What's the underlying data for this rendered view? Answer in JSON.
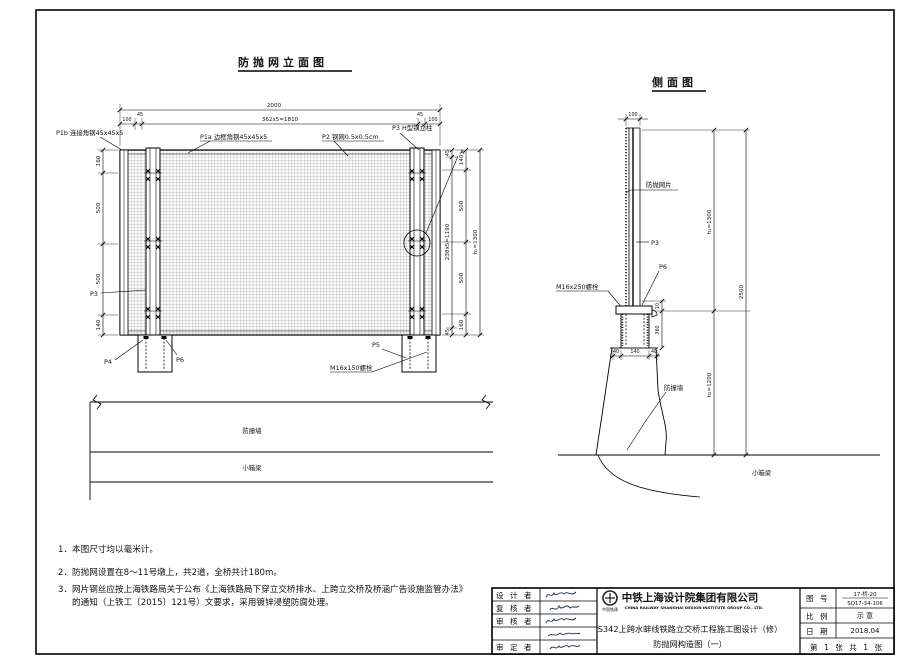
{
  "elevation": {
    "title": "防抛网立面图",
    "dim_total": "2000",
    "dim_100l": "100",
    "dim_45l": "45",
    "dim_mid": "362x5=1810",
    "dim_45r": "45",
    "dim_100r": "100",
    "left_dims": [
      "160",
      "500",
      "500",
      "140"
    ],
    "right_inner": [
      "45",
      "238x5=1190",
      "45"
    ],
    "right_outer": [
      "140",
      "500",
      "500",
      "160"
    ],
    "height_label": "h₁=1300",
    "label_p1b": "P1b 连接角钢45x45x5",
    "label_p1a": "P1a 边框角钢45x45x5",
    "label_p2": "P2 钢网0.5x0.5cm",
    "label_p3_col": "P3 H型钢立柱",
    "detail_a": "A",
    "label_p3": "P3",
    "label_p4": "P4",
    "label_p6": "P6",
    "label_p5": "P5",
    "label_bolt": "M16x150螺栓",
    "wall": "防撞墙",
    "girder": "小箱梁"
  },
  "side": {
    "title": "侧面图",
    "dim_top": "100",
    "label_net": "防抛网片",
    "label_p3": "P3",
    "label_p6": "P6",
    "label_bolt": "M16x250螺栓",
    "base_dims": [
      "40",
      "140",
      "40"
    ],
    "small_dims": [
      "10",
      "360"
    ],
    "h1": "h₁=1300",
    "h2": "h₂=1200",
    "total": "2500",
    "wall": "防撞墙",
    "girder": "小箱梁"
  },
  "notes": {
    "line1": "1．本图尺寸均以毫米计。",
    "line2": "2．防抛网设置在8～11号墩上，共2道，全桥共计180m。",
    "line3": "3．网片钢丝应按上海铁路局关于公布《上海铁路局下穿立交桥排水、上跨立交桥及桥涵广告设施监管办法》",
    "line4": "的通知（上铁工〔2015〕121号）文要求，采用镀锌浸塑防腐处理。"
  },
  "titleblock": {
    "role1": "设 计 者",
    "role2": "复 核 者",
    "role3": "审 核 者",
    "role5": "审 定 者",
    "emblem": "中国铁建",
    "company_cn": "中铁上海设计院集团有限公司",
    "company_en": "CHINA RAILWAY SHANGHAI DESIGN INSTITUTE GROUP CO., LTD.",
    "project": "S342上跨水蚌线铁路立交桥工程施工图设计（修）",
    "drawing": "防抛网构造图（一）",
    "f_no_label": "图  号",
    "f_no_1": "17-桥-20",
    "f_no_2": "SQ17-34-106",
    "f_scale_label": "比  例",
    "f_scale": "示 意",
    "f_date_label": "日  期",
    "f_date": "2018.04",
    "sheet_no": "第 1 张 共 1 张"
  }
}
